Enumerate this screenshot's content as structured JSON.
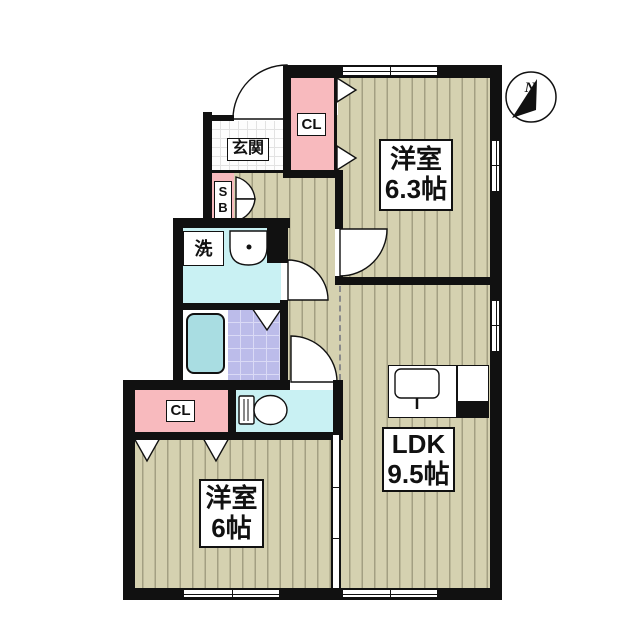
{
  "title": "1LDK+2洋室 間取り図",
  "compass": {
    "north_label": "N"
  },
  "rooms": {
    "bedroom_ne": {
      "line1": "洋室",
      "line2": "6.3帖"
    },
    "ldk": {
      "line1": "LDK",
      "line2": "9.5帖"
    },
    "bedroom_sw": {
      "line1": "洋室",
      "line2": "6帖"
    },
    "entrance": {
      "label": "玄関"
    },
    "laundry": {
      "label": "洗"
    },
    "closet_north": {
      "label": "CL"
    },
    "closet_south": {
      "label": "CL"
    },
    "shoe_box": {
      "line1": "S",
      "line2": "B"
    }
  },
  "colors": {
    "wall": "#111111",
    "floor": "#d5d1b0",
    "floor_stripe": "#a39f82",
    "pink": "#f8babe",
    "cyan": "#c9f1f3",
    "tub": "#a9dde2",
    "tile": "#bcbcea",
    "tile_grid": "#dadaf6"
  }
}
